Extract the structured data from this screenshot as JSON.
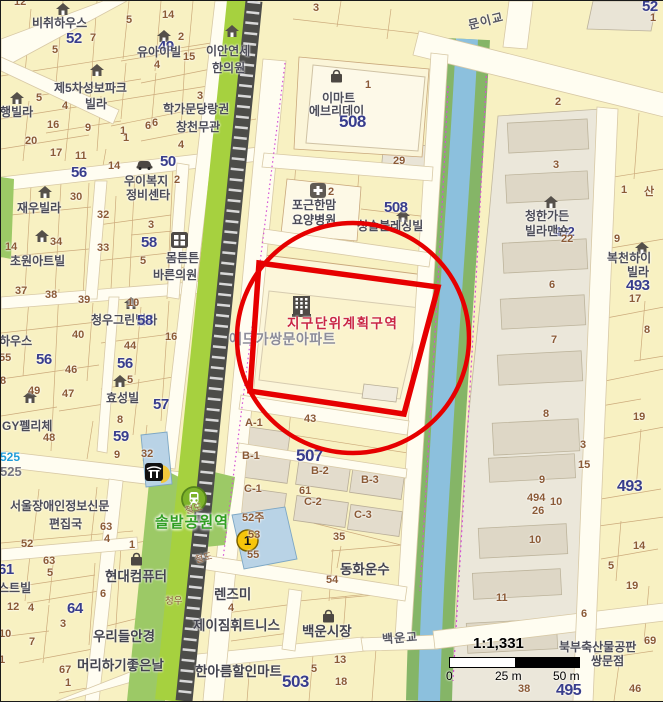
{
  "map": {
    "colors": {
      "annotation_red": "#e60000",
      "parcel_yellow": "#f8f1c2",
      "parcel_cream": "#fcf6da",
      "building_gray": "#ded7c6",
      "water_blue": "#8cc0dd",
      "park_green": "#9cc966",
      "railway_green": "#a6d13f",
      "navy_number": "#383d8c",
      "brown_number": "#8b5a36",
      "station_green": "#2f9e21",
      "zone_red": "#c92644"
    },
    "scale": {
      "ratio": "1:1,331",
      "tick0": "0",
      "tick1": "25 m",
      "tick2": "50 m"
    },
    "labels": [
      {
        "t": "12",
        "x": 13,
        "y": -4,
        "c": "nb"
      },
      {
        "t": "비취하우스",
        "x": 31,
        "y": 16,
        "c": "nm"
      },
      {
        "t": "52",
        "x": 65,
        "y": 30,
        "c": "nv"
      },
      {
        "t": "7",
        "x": 89,
        "y": 32,
        "c": "nb"
      },
      {
        "t": "5",
        "x": 51,
        "y": 44,
        "c": "nb"
      },
      {
        "t": "5",
        "x": 125,
        "y": 14,
        "c": "nb"
      },
      {
        "t": "14",
        "x": 161,
        "y": 9,
        "c": "nb"
      },
      {
        "t": "2",
        "x": 177,
        "y": 31,
        "c": "nb"
      },
      {
        "t": "49",
        "x": 157,
        "y": 38,
        "c": "nv"
      },
      {
        "t": "유아이빌",
        "x": 136,
        "y": 45,
        "c": "nm"
      },
      {
        "t": "4",
        "x": 153,
        "y": 59,
        "c": "nb"
      },
      {
        "t": "15",
        "x": 182,
        "y": 51,
        "c": "nb"
      },
      {
        "t": "이안연세",
        "x": 205,
        "y": 44,
        "c": "nm"
      },
      {
        "t": "한의원",
        "x": 211,
        "y": 61,
        "c": "nm"
      },
      {
        "t": "3",
        "x": 312,
        "y": 2,
        "c": "nb"
      },
      {
        "t": "제5차성보파크",
        "x": 53,
        "y": 81,
        "c": "nm"
      },
      {
        "t": "빌라",
        "x": 84,
        "y": 97,
        "c": "nm"
      },
      {
        "t": "은행빌라",
        "x": -12,
        "y": 105,
        "c": "nm"
      },
      {
        "t": "5",
        "x": 35,
        "y": 92,
        "c": "nb"
      },
      {
        "t": "4",
        "x": 61,
        "y": 100,
        "c": "nb"
      },
      {
        "t": "16",
        "x": 46,
        "y": 119,
        "c": "nb"
      },
      {
        "t": "9",
        "x": 84,
        "y": 122,
        "c": "nb"
      },
      {
        "t": "1",
        "x": 119,
        "y": 125,
        "c": "nb"
      },
      {
        "t": "6",
        "x": 151,
        "y": 117,
        "c": "nb"
      },
      {
        "t": "3",
        "x": 196,
        "y": 90,
        "c": "nb"
      },
      {
        "t": "20",
        "x": 24,
        "y": 135,
        "c": "nb"
      },
      {
        "t": "17",
        "x": 49,
        "y": 147,
        "c": "nb"
      },
      {
        "t": "11",
        "x": 74,
        "y": 150,
        "c": "nb"
      },
      {
        "t": "14",
        "x": 107,
        "y": 160,
        "c": "nb"
      },
      {
        "t": "56",
        "x": 70,
        "y": 164,
        "c": "nv"
      },
      {
        "t": "학가문당랑권",
        "x": 162,
        "y": 102,
        "c": "nm"
      },
      {
        "t": "창천무관",
        "x": 175,
        "y": 120,
        "c": "nm"
      },
      {
        "t": "6",
        "x": 144,
        "y": 120,
        "c": "nb"
      },
      {
        "t": "1",
        "x": 122,
        "y": 132,
        "c": "nb"
      },
      {
        "t": "4",
        "x": 177,
        "y": 139,
        "c": "nb"
      },
      {
        "t": "50",
        "x": 159,
        "y": 153,
        "c": "nv"
      },
      {
        "t": "우이복지",
        "x": 123,
        "y": 174,
        "c": "nm"
      },
      {
        "t": "2",
        "x": 173,
        "y": 174,
        "c": "nb"
      },
      {
        "t": "정비센타",
        "x": 125,
        "y": 188,
        "c": "nm"
      },
      {
        "t": "14",
        "x": 4,
        "y": 241,
        "c": "nb"
      },
      {
        "t": "30",
        "x": 69,
        "y": 191,
        "c": "nb"
      },
      {
        "t": "재우빌라",
        "x": 16,
        "y": 201,
        "c": "nm"
      },
      {
        "t": "32",
        "x": 96,
        "y": 209,
        "c": "nb"
      },
      {
        "t": "3",
        "x": 147,
        "y": 219,
        "c": "nb"
      },
      {
        "t": "34",
        "x": 49,
        "y": 236,
        "c": "nb"
      },
      {
        "t": "58",
        "x": 140,
        "y": 234,
        "c": "nv"
      },
      {
        "t": "33",
        "x": 96,
        "y": 242,
        "c": "nb"
      },
      {
        "t": "5",
        "x": 139,
        "y": 255,
        "c": "nb"
      },
      {
        "t": "몸튼튼",
        "x": 165,
        "y": 251,
        "c": "nm"
      },
      {
        "t": "바른의원",
        "x": 152,
        "y": 268,
        "c": "nm"
      },
      {
        "t": "초원아트빌",
        "x": 9,
        "y": 254,
        "c": "nm"
      },
      {
        "t": "37",
        "x": 14,
        "y": 285,
        "c": "nb"
      },
      {
        "t": "38",
        "x": 44,
        "y": 289,
        "c": "nb"
      },
      {
        "t": "39",
        "x": 77,
        "y": 294,
        "c": "nb"
      },
      {
        "t": "10",
        "x": 126,
        "y": 297,
        "c": "nb"
      },
      {
        "t": "청우그린빌라",
        "x": 90,
        "y": 313,
        "c": "nm"
      },
      {
        "t": "58",
        "x": 136,
        "y": 312,
        "c": "nv"
      },
      {
        "t": "하우스",
        "x": -2,
        "y": 334,
        "c": "nm"
      },
      {
        "t": "40",
        "x": 71,
        "y": 329,
        "c": "nb"
      },
      {
        "t": "44",
        "x": 123,
        "y": 340,
        "c": "nb"
      },
      {
        "t": "16",
        "x": 164,
        "y": 331,
        "c": "nb"
      },
      {
        "t": "55",
        "x": -2,
        "y": 352,
        "c": "nb"
      },
      {
        "t": "56",
        "x": 35,
        "y": 351,
        "c": "nv"
      },
      {
        "t": "46",
        "x": 64,
        "y": 364,
        "c": "nb"
      },
      {
        "t": "56",
        "x": 116,
        "y": 355,
        "c": "nv"
      },
      {
        "t": "8",
        "x": -1,
        "y": 375,
        "c": "nb"
      },
      {
        "t": "49",
        "x": 27,
        "y": 385,
        "c": "nb"
      },
      {
        "t": "47",
        "x": 61,
        "y": 388,
        "c": "nb"
      },
      {
        "t": "5",
        "x": 126,
        "y": 374,
        "c": "nb"
      },
      {
        "t": "효성빌",
        "x": 105,
        "y": 391,
        "c": "nm"
      },
      {
        "t": "57",
        "x": 152,
        "y": 396,
        "c": "nv"
      },
      {
        "t": "8",
        "x": 116,
        "y": 414,
        "c": "nb"
      },
      {
        "t": "GY펠리체",
        "x": 1,
        "y": 419,
        "c": "nm"
      },
      {
        "t": "48",
        "x": 42,
        "y": 432,
        "c": "nb"
      },
      {
        "t": "59",
        "x": 112,
        "y": 428,
        "c": "nv"
      },
      {
        "t": "9",
        "x": 113,
        "y": 449,
        "c": "nb"
      },
      {
        "t": "32",
        "x": 140,
        "y": 448,
        "c": "nb"
      },
      {
        "t": "525",
        "x": -1,
        "y": 450,
        "c": "nbl"
      },
      {
        "t": "525",
        "x": -1,
        "y": 464,
        "c": "ngr"
      },
      {
        "t": "서울장애인정보신문",
        "x": 9,
        "y": 499,
        "c": "nm"
      },
      {
        "t": "편집국",
        "x": 48,
        "y": 517,
        "c": "nm"
      },
      {
        "t": "63",
        "x": 99,
        "y": 521,
        "c": "nb"
      },
      {
        "t": "4",
        "x": 103,
        "y": 533,
        "c": "nb"
      },
      {
        "t": "52",
        "x": 20,
        "y": 538,
        "c": "nb"
      },
      {
        "t": "63",
        "x": 42,
        "y": 555,
        "c": "nb"
      },
      {
        "t": "5",
        "x": 46,
        "y": 567,
        "c": "nb"
      },
      {
        "t": "61",
        "x": -3,
        "y": 561,
        "c": "nv"
      },
      {
        "t": "스트빌",
        "x": -3,
        "y": 581,
        "c": "nm"
      },
      {
        "t": "12",
        "x": 6,
        "y": 601,
        "c": "nb"
      },
      {
        "t": "4",
        "x": 27,
        "y": 602,
        "c": "nb"
      },
      {
        "t": "64",
        "x": 66,
        "y": 600,
        "c": "nv"
      },
      {
        "t": "3",
        "x": 59,
        "y": 618,
        "c": "nb"
      },
      {
        "t": "1",
        "x": 128,
        "y": 539,
        "c": "nb"
      },
      {
        "t": "현대컴퓨터",
        "x": 104,
        "y": 569,
        "c": "nl"
      },
      {
        "t": "6",
        "x": 99,
        "y": 588,
        "c": "nb"
      },
      {
        "t": "10",
        "x": -2,
        "y": 628,
        "c": "nb"
      },
      {
        "t": "7",
        "x": 28,
        "y": 636,
        "c": "nb"
      },
      {
        "t": "우리들안경",
        "x": 92,
        "y": 629,
        "c": "nl"
      },
      {
        "t": "1",
        "x": -2,
        "y": 654,
        "c": "nb"
      },
      {
        "t": "67",
        "x": 58,
        "y": 664,
        "c": "nb"
      },
      {
        "t": "1",
        "x": 64,
        "y": 677,
        "c": "nb"
      },
      {
        "t": "머리하기좋은날",
        "x": 76,
        "y": 658,
        "c": "nl"
      },
      {
        "t": "한아름할인마트",
        "x": 194,
        "y": 664,
        "c": "nl"
      },
      {
        "t": "503",
        "x": 281,
        "y": 672,
        "c": "nv",
        "fs": 17
      },
      {
        "t": "제이짐휘트니스",
        "x": 192,
        "y": 618,
        "c": "nl"
      },
      {
        "t": "렌즈미",
        "x": 213,
        "y": 587,
        "c": "nl"
      },
      {
        "t": "4",
        "x": 227,
        "y": 602,
        "c": "nb"
      },
      {
        "t": "청우",
        "x": 164,
        "y": 596,
        "c": "rl"
      },
      {
        "t": "철도",
        "x": 184,
        "y": 504,
        "c": "rl",
        "r": -14
      },
      {
        "t": "철도",
        "x": 194,
        "y": 553,
        "c": "rl",
        "r": -14
      },
      {
        "t": "52주",
        "x": 241,
        "y": 512,
        "c": "nb"
      },
      {
        "t": "53",
        "x": 247,
        "y": 529,
        "c": "nb"
      },
      {
        "t": "55",
        "x": 246,
        "y": 549,
        "c": "nb"
      },
      {
        "t": "솔밭공원역",
        "x": 154,
        "y": 514,
        "c": "st"
      },
      {
        "t": "C-1",
        "x": 243,
        "y": 483,
        "c": "nb"
      },
      {
        "t": "C-2",
        "x": 303,
        "y": 496,
        "c": "nb"
      },
      {
        "t": "C-3",
        "x": 353,
        "y": 509,
        "c": "nb"
      },
      {
        "t": "B-1",
        "x": 241,
        "y": 450,
        "c": "nb"
      },
      {
        "t": "B-2",
        "x": 310,
        "y": 465,
        "c": "nb"
      },
      {
        "t": "B-3",
        "x": 360,
        "y": 474,
        "c": "nb"
      },
      {
        "t": "507",
        "x": 295,
        "y": 446,
        "c": "nv",
        "fs": 17
      },
      {
        "t": "61",
        "x": 298,
        "y": 485,
        "c": "nb"
      },
      {
        "t": "A-1",
        "x": 244,
        "y": 417,
        "c": "nb"
      },
      {
        "t": "43",
        "x": 303,
        "y": 413,
        "c": "nb"
      },
      {
        "t": "35",
        "x": 332,
        "y": 531,
        "c": "nb"
      },
      {
        "t": "동화운수",
        "x": 339,
        "y": 562,
        "c": "nl"
      },
      {
        "t": "54",
        "x": 325,
        "y": 574,
        "c": "nb"
      },
      {
        "t": "백운시장",
        "x": 301,
        "y": 624,
        "c": "nl"
      },
      {
        "t": "13",
        "x": 333,
        "y": 654,
        "c": "nb"
      },
      {
        "t": "5",
        "x": 310,
        "y": 663,
        "c": "nb"
      },
      {
        "t": "18",
        "x": 334,
        "y": 676,
        "c": "nb"
      },
      {
        "t": "백운교",
        "x": 381,
        "y": 631,
        "c": "br",
        "r": -4
      },
      {
        "t": "문이교",
        "x": 467,
        "y": 14,
        "c": "br",
        "r": -14
      },
      {
        "t": "이마트",
        "x": 321,
        "y": 91,
        "c": "nm"
      },
      {
        "t": "에브리데이",
        "x": 308,
        "y": 104,
        "c": "nm"
      },
      {
        "t": "508",
        "x": 338,
        "y": 112,
        "c": "nv",
        "fs": 17
      },
      {
        "t": "1",
        "x": 364,
        "y": 79,
        "c": "nb"
      },
      {
        "t": "29",
        "x": 392,
        "y": 155,
        "c": "nb"
      },
      {
        "t": "2",
        "x": 327,
        "y": 186,
        "c": "nb"
      },
      {
        "t": "포근한맘",
        "x": 291,
        "y": 198,
        "c": "nm"
      },
      {
        "t": "요양병원",
        "x": 291,
        "y": 213,
        "c": "nm"
      },
      {
        "t": "508",
        "x": 383,
        "y": 199,
        "c": "nv",
        "fs": 15
      },
      {
        "t": "청솔블레싱빌",
        "x": 356,
        "y": 219,
        "c": "nm"
      },
      {
        "t": "지구단위계획구역",
        "x": 286,
        "y": 316,
        "c": "rz"
      },
      {
        "t": "에드가쌍문아파트",
        "x": 228,
        "y": 331,
        "c": "an"
      },
      {
        "t": "2",
        "x": 554,
        "y": 96,
        "c": "nb"
      },
      {
        "t": "3",
        "x": 552,
        "y": 159,
        "c": "nb"
      },
      {
        "t": "청한가든",
        "x": 524,
        "y": 209,
        "c": "nm"
      },
      {
        "t": "492",
        "x": 553,
        "y": 224,
        "c": "nv",
        "fs": 13
      },
      {
        "t": "빌라맨숀",
        "x": 524,
        "y": 224,
        "c": "nm"
      },
      {
        "t": "22",
        "x": 560,
        "y": 233,
        "c": "nb"
      },
      {
        "t": "6",
        "x": 548,
        "y": 279,
        "c": "nb"
      },
      {
        "t": "7",
        "x": 550,
        "y": 334,
        "c": "nb"
      },
      {
        "t": "8",
        "x": 542,
        "y": 408,
        "c": "nb"
      },
      {
        "t": "9",
        "x": 538,
        "y": 474,
        "c": "nb"
      },
      {
        "t": "494",
        "x": 526,
        "y": 492,
        "c": "nb"
      },
      {
        "t": "26",
        "x": 531,
        "y": 505,
        "c": "nb"
      },
      {
        "t": "10",
        "x": 528,
        "y": 534,
        "c": "nb"
      },
      {
        "t": "11",
        "x": 495,
        "y": 592,
        "c": "nb"
      },
      {
        "t": "52",
        "x": 641,
        "y": -2,
        "c": "nv"
      },
      {
        "t": "1",
        "x": 649,
        "y": 12,
        "c": "nb"
      },
      {
        "t": "1",
        "x": 620,
        "y": 184,
        "c": "nb"
      },
      {
        "t": "산",
        "x": 643,
        "y": 186,
        "c": "nb"
      },
      {
        "t": "9",
        "x": 613,
        "y": 233,
        "c": "nb"
      },
      {
        "t": "복천하이",
        "x": 606,
        "y": 251,
        "c": "nm"
      },
      {
        "t": "빌라",
        "x": 626,
        "y": 265,
        "c": "nm"
      },
      {
        "t": "493",
        "x": 625,
        "y": 277,
        "c": "nv"
      },
      {
        "t": "17",
        "x": 628,
        "y": 293,
        "c": "nb"
      },
      {
        "t": "8",
        "x": 643,
        "y": 324,
        "c": "nb"
      },
      {
        "t": "19",
        "x": 632,
        "y": 411,
        "c": "nb"
      },
      {
        "t": "3",
        "x": 579,
        "y": 439,
        "c": "nb"
      },
      {
        "t": "15",
        "x": 577,
        "y": 459,
        "c": "nb"
      },
      {
        "t": "493",
        "x": 616,
        "y": 478,
        "c": "nv",
        "fs": 16
      },
      {
        "t": "10",
        "x": 549,
        "y": 496,
        "c": "nb"
      },
      {
        "t": "14",
        "x": 632,
        "y": 540,
        "c": "nb"
      },
      {
        "t": "5",
        "x": 607,
        "y": 560,
        "c": "nb"
      },
      {
        "t": "19",
        "x": 625,
        "y": 580,
        "c": "nb"
      },
      {
        "t": "6",
        "x": 580,
        "y": 608,
        "c": "nb"
      },
      {
        "t": "69",
        "x": 643,
        "y": 635,
        "c": "nb"
      },
      {
        "t": "북부축산물공판",
        "x": 558,
        "y": 640,
        "c": "nm"
      },
      {
        "t": "쌍문점",
        "x": 590,
        "y": 654,
        "c": "nm"
      },
      {
        "t": "495",
        "x": 555,
        "y": 682,
        "c": "nv",
        "fs": 16
      },
      {
        "t": "46",
        "x": 628,
        "y": 683,
        "c": "nb"
      },
      {
        "t": "38",
        "x": 517,
        "y": 683,
        "c": "nb"
      }
    ],
    "icons": [
      {
        "n": "house-icon",
        "t": "house",
        "x": 55,
        "y": 2
      },
      {
        "n": "house-icon",
        "t": "house",
        "x": 156,
        "y": 29
      },
      {
        "n": "house-icon",
        "t": "house",
        "x": 224,
        "y": 24
      },
      {
        "n": "house-icon",
        "t": "house",
        "x": 89,
        "y": 63
      },
      {
        "n": "house-icon",
        "t": "house",
        "x": 9,
        "y": 91
      },
      {
        "n": "house-icon",
        "t": "house",
        "x": 37,
        "y": 185
      },
      {
        "n": "house-icon",
        "t": "house",
        "x": 34,
        "y": 229
      },
      {
        "n": "house-icon",
        "t": "house",
        "x": 123,
        "y": 296
      },
      {
        "n": "house-icon",
        "t": "house",
        "x": 22,
        "y": 390
      },
      {
        "n": "house-icon",
        "t": "house",
        "x": 112,
        "y": 374
      },
      {
        "n": "house-icon",
        "t": "house",
        "x": 395,
        "y": 209
      },
      {
        "n": "house-icon",
        "t": "house",
        "x": 543,
        "y": 195
      },
      {
        "n": "house-icon",
        "t": "house",
        "x": 634,
        "y": 241
      },
      {
        "n": "clinic-icon",
        "t": "clinic",
        "x": 170,
        "y": 231
      },
      {
        "n": "hospital-cross-icon",
        "t": "hospital",
        "x": 309,
        "y": 182
      },
      {
        "n": "mart-bag-icon",
        "t": "bag",
        "x": 328,
        "y": 68
      },
      {
        "n": "market-bag-icon",
        "t": "bag",
        "x": 320,
        "y": 608
      },
      {
        "n": "shop-bag-icon",
        "t": "bag",
        "x": 128,
        "y": 551
      },
      {
        "n": "car-icon",
        "t": "car",
        "x": 135,
        "y": 158
      },
      {
        "n": "apartment-icon",
        "t": "apt",
        "x": 291,
        "y": 295
      },
      {
        "n": "half-disc-icon",
        "t": "halfdisc",
        "x": 160,
        "y": 464
      },
      {
        "n": "temple-icon",
        "t": "temple",
        "x": 144,
        "y": 462
      },
      {
        "n": "station-icon",
        "t": "station",
        "x": 180,
        "y": 485
      },
      {
        "n": "line-1-badge",
        "t": "badge1",
        "x": 235,
        "y": 528,
        "label": "1"
      }
    ]
  }
}
